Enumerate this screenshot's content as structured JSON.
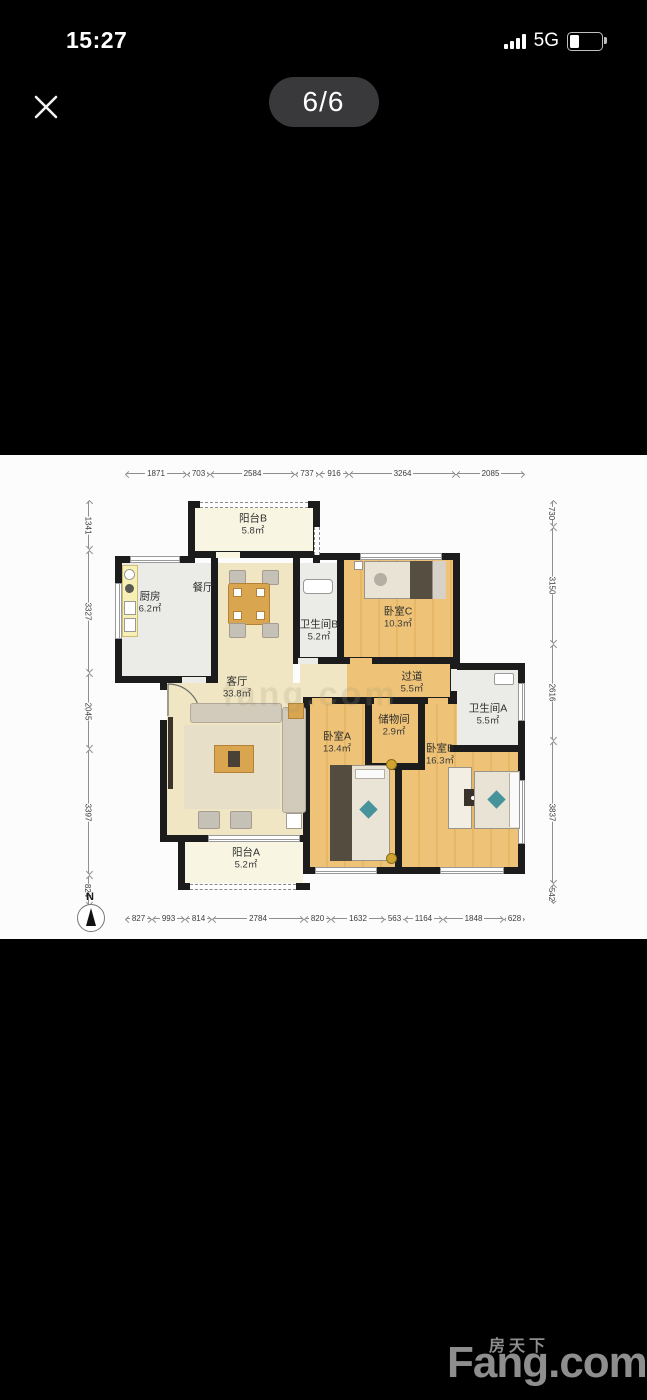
{
  "status_bar": {
    "time": "15:27",
    "network": "5G",
    "signal_icon": "signal-bars-4",
    "battery_icon": "battery-low"
  },
  "viewer": {
    "page_indicator": "6/6",
    "close_icon": "close-x"
  },
  "floor_plan": {
    "compass": "N",
    "watermark": "fang.com",
    "dims_top": [
      "1871",
      "703",
      "2584",
      "737",
      "916",
      "3264",
      "2085"
    ],
    "dims_bottom": [
      "827",
      "993",
      "814",
      "2784",
      "820",
      "1632",
      "563",
      "1164",
      "1848",
      "628"
    ],
    "dims_left": [
      "1341",
      "3327",
      "2045",
      "3397",
      "824"
    ],
    "dims_right": [
      "730",
      "3150",
      "2616",
      "3837",
      "542"
    ],
    "rooms": {
      "balcony_b": {
        "name": "阳台B",
        "area": "5.8㎡"
      },
      "kitchen": {
        "name": "厨房",
        "area": "6.2㎡"
      },
      "dining": {
        "name": "餐厅",
        "area": ""
      },
      "bath_b": {
        "name": "卫生间B",
        "area": "5.2㎡"
      },
      "bedroom_c": {
        "name": "卧室C",
        "area": "10.3㎡"
      },
      "hallway": {
        "name": "过道",
        "area": "5.5㎡"
      },
      "bath_a": {
        "name": "卫生间A",
        "area": "5.5㎡"
      },
      "living": {
        "name": "客厅",
        "area": "33.8㎡"
      },
      "bedroom_a": {
        "name": "卧室A",
        "area": "13.4㎡"
      },
      "storage": {
        "name": "储物间",
        "area": "2.9㎡"
      },
      "bedroom_b": {
        "name": "卧室B",
        "area": "16.3㎡"
      },
      "balcony_a": {
        "name": "阳台A",
        "area": "5.2㎡"
      }
    },
    "colors": {
      "wall": "#1c1c1c",
      "wood_floor": "#eec377",
      "living_floor": "#f0e6c3",
      "balcony_floor": "#f8f6e3",
      "wet_floor": "#ebebe8",
      "accent_furniture": "#d9a54e"
    }
  },
  "footer_logo": {
    "cn": "房天下",
    "en": "Fang.com"
  }
}
